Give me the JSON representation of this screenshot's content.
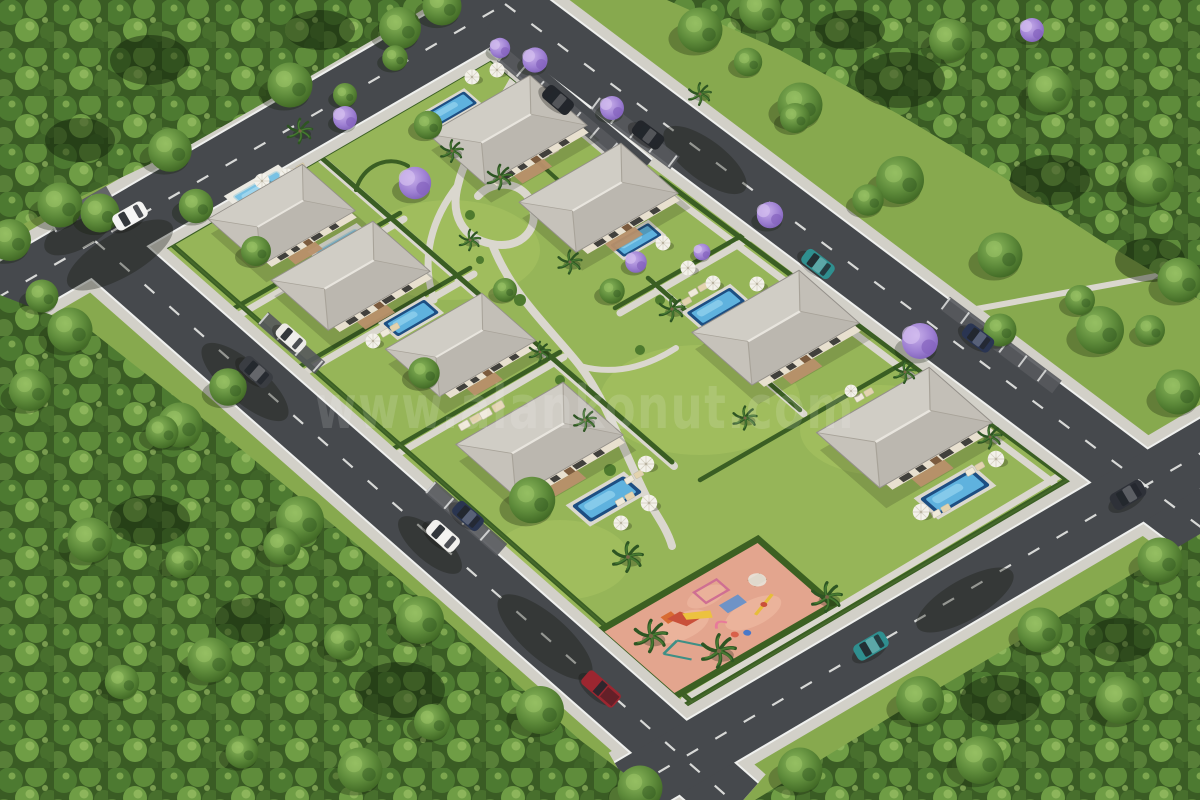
{
  "image": {
    "type": "3D architectural aerial rendering",
    "subject": "Gated residential villa community master plan",
    "view": "High-angle oblique aerial view of a rectangular parcel ringed by roads and dense forest"
  },
  "watermark": {
    "text": "www.alankonut.com"
  },
  "site_plan": {
    "villa_count": 8,
    "pool_count": 8,
    "villas": [
      {
        "id": 1,
        "location": "north, below top road corner",
        "roof": "light gray hip roof",
        "pool": "northwest of house"
      },
      {
        "id": 2,
        "location": "north-center",
        "roof": "light gray hip roof",
        "pool": "southeast of house"
      },
      {
        "id": 3,
        "location": "west, along northwest road",
        "roof": "light gray hip roof",
        "pool": "north of house"
      },
      {
        "id": 4,
        "location": "west-center",
        "roof": "light gray hip roof",
        "pool": "northeast of house"
      },
      {
        "id": 5,
        "location": "center-west",
        "roof": "light gray hip roof",
        "pool": "west of house"
      },
      {
        "id": 6,
        "location": "south-center",
        "roof": "light gray hip roof",
        "pool": "southeast of house"
      },
      {
        "id": 7,
        "location": "east-center",
        "roof": "light gray hip roof",
        "pool": "northwest of house"
      },
      {
        "id": 8,
        "location": "southeast",
        "roof": "light gray hip roof",
        "pool": "south of house"
      }
    ],
    "playground": {
      "location": "south corner of the compound",
      "surface_color": "#e3a58e",
      "equipment": [
        "slides",
        "climbing frames",
        "swing set",
        "seesaw",
        "spring riders",
        "picnic table"
      ]
    },
    "roads": {
      "layout": "four perimeter roads forming a rotated rectangle with corner junctions",
      "markings": "solid white edge lines with dashed white center line",
      "parking": "white-marked parallel parking bays along inner edges",
      "sidewalks": "light concrete sidewalks on both sides"
    },
    "vehicles": [
      {
        "color": "white",
        "position": "northwest road, upper left"
      },
      {
        "color": "dark gray sedan",
        "position": "southwest road"
      },
      {
        "color": "white",
        "position": "parked bay, southwest road"
      },
      {
        "color": "dark blue",
        "position": "parked bay, southwest road"
      },
      {
        "color": "white",
        "position": "southwest road, center"
      },
      {
        "color": "dark red pickup truck",
        "position": "southwest road, bottom"
      },
      {
        "color": "teal with white roof",
        "position": "southeast road"
      },
      {
        "color": "dark SUV",
        "position": "southeast road, right"
      },
      {
        "color": "teal with white roof",
        "position": "northeast road"
      },
      {
        "color": "dark",
        "position": "parked, interior lane at north entrance"
      },
      {
        "color": "dark",
        "position": "parked bay, northeast road"
      },
      {
        "color": "dark blue",
        "position": "parked bay, northeast road, east"
      }
    ],
    "landscape": {
      "surrounding": "dense green forest on all four sides",
      "palm_trees": true,
      "jacaranda_trees": 10,
      "hedged_private_plots": true,
      "curved_garden_paths": true,
      "pool_styles": [
        "dark-blue rimmed",
        "white-deck light blue"
      ]
    }
  },
  "palette": {
    "lawn": "#96b558",
    "outer_grass": "#87a94e",
    "forest": "#3a5c24",
    "asphalt": "#46494d",
    "sidewalk": "#d2d0c8",
    "roof": "#c6c2ba",
    "pool_water": "#5fb2de",
    "playground": "#e3a58e",
    "jacaranda": "#9d7fd2",
    "hedge": "#3a5e23"
  }
}
